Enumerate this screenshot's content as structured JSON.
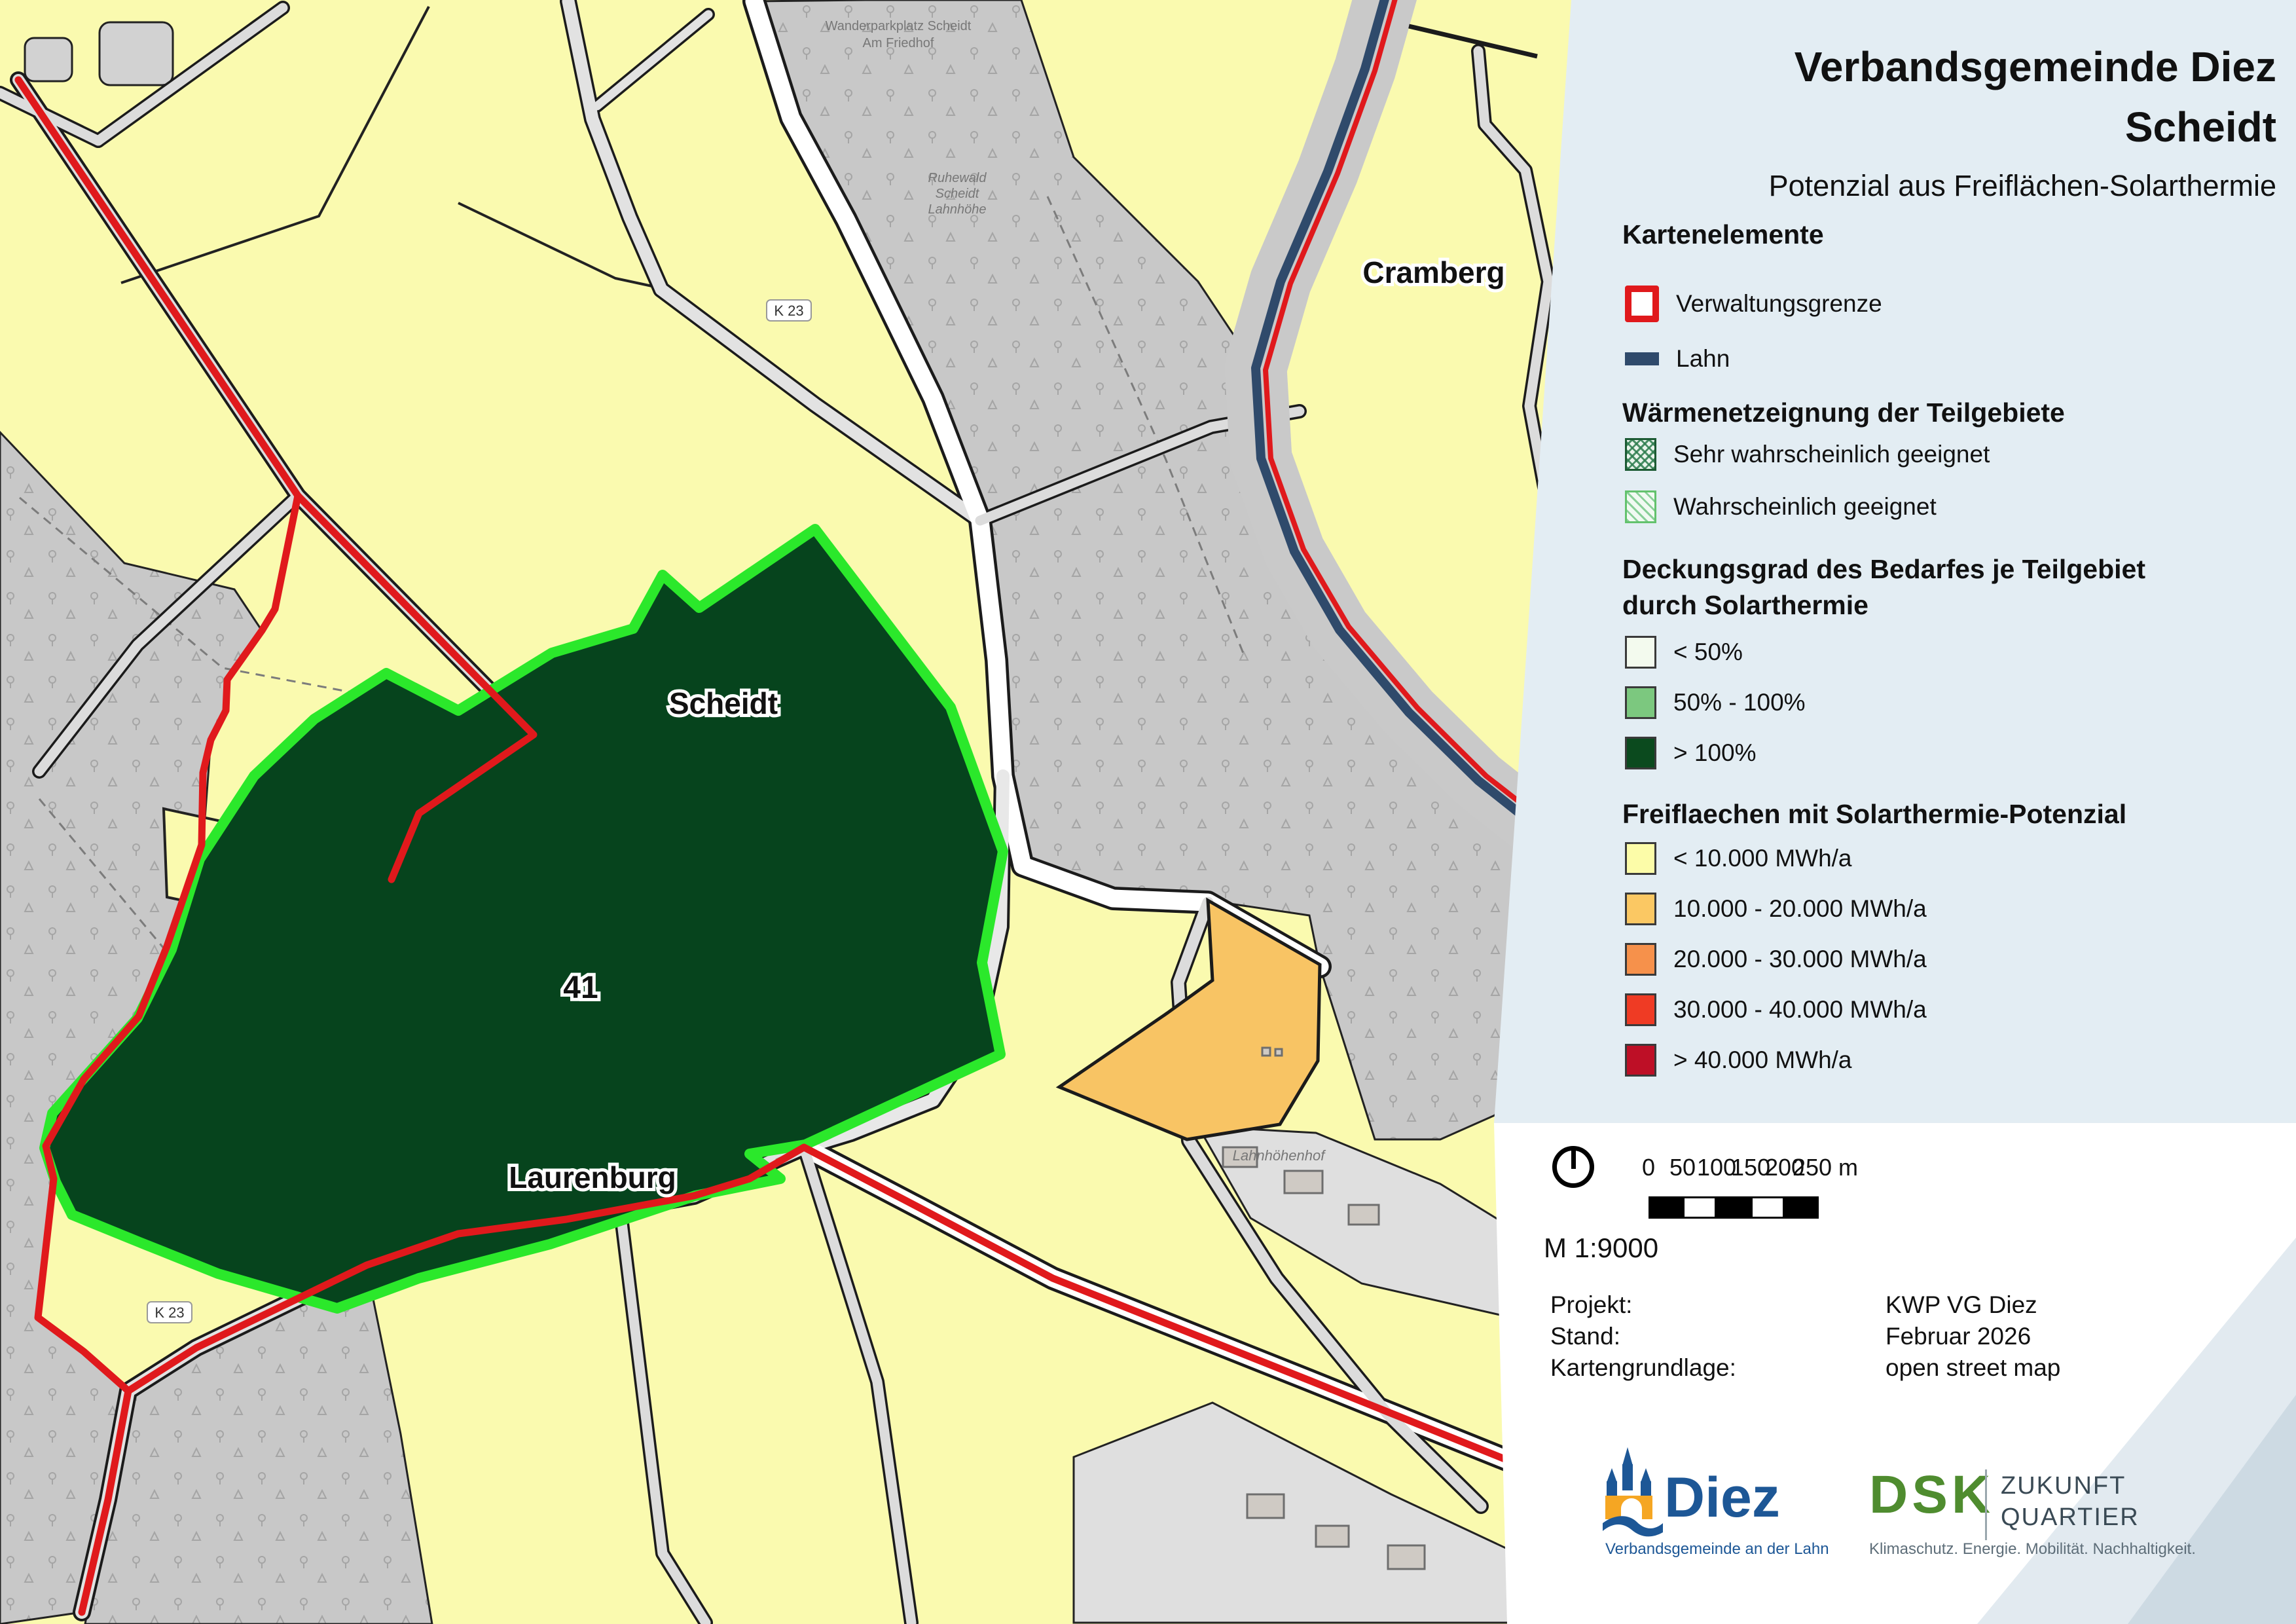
{
  "title": {
    "line1": "Verbandsgemeinde Diez",
    "line2": "Scheidt",
    "subtitle": "Potenzial aus Freiflächen-Solarthermie"
  },
  "legend": {
    "kartenelemente": {
      "heading": "Kartenelemente",
      "items": [
        {
          "label": "Verwaltungsgrenze",
          "color": "#E0191C"
        },
        {
          "label": "Lahn",
          "color": "#2F4A6B"
        }
      ]
    },
    "waermenetz": {
      "heading": "Wärmenetzeignung der Teilgebiete",
      "items": [
        {
          "label": "Sehr wahrscheinlich geeignet",
          "border_color": "#1C5A33"
        },
        {
          "label": "Wahrscheinlich geeignet",
          "border_color": "#63C26D"
        }
      ]
    },
    "deckungsgrad": {
      "heading_line1": "Deckungsgrad des Bedarfes je Teilgebiet",
      "heading_line2": "durch Solarthermie",
      "items": [
        {
          "label": "< 50%",
          "color": "#F3FAEE"
        },
        {
          "label": "50% - 100%",
          "color": "#7CC87F"
        },
        {
          "label": "> 100%",
          "color": "#0B4A1E"
        }
      ]
    },
    "freiflaechen": {
      "heading": "Freiflaechen mit Solarthermie-Potenzial",
      "items": [
        {
          "label": "< 10.000 MWh/a",
          "color": "#FCFCA8"
        },
        {
          "label": "10.000 - 20.000 MWh/a",
          "color": "#FBC863"
        },
        {
          "label": "20.000 - 30.000 MWh/a",
          "color": "#F6914B"
        },
        {
          "label": "30.000 - 40.000 MWh/a",
          "color": "#EF3B24"
        },
        {
          "label": "> 40.000 MWh/a",
          "color": "#BE0F26"
        }
      ]
    }
  },
  "map": {
    "labels": {
      "scheidt": "Scheidt",
      "laurenburg": "Laurenburg",
      "cramberg": "Cramberg",
      "area_number": "41",
      "road_badge": "K 23",
      "wanderparkplatz_1": "Wanderparkplatz Scheidt",
      "wanderparkplatz_2": "Am Friedhof",
      "ruhewald_1": "Ruhewald",
      "ruhewald_2": "Scheidt",
      "ruhewald_3": "Lahnhöhe",
      "lahnhoehenhof": "Lahnhöhenhof"
    },
    "colors": {
      "parcel_yellow": "#FAFAAF",
      "forest_gray": "#C8C8C8",
      "boundary_red": "#E0191C",
      "river_navy": "#2F4A6B",
      "teilgebiet_green_fill": "#06441D",
      "teilgebiet_green_border": "#2BE82B",
      "orange_parcel": "#F8C464",
      "panel_blue": "#E3EDF3"
    }
  },
  "scalebar": {
    "ticks": [
      "0",
      "50",
      "100",
      "150",
      "200"
    ],
    "last_tick": "250 m",
    "scale_text": "M 1:9000"
  },
  "project": {
    "rows": [
      {
        "label": "Projekt:",
        "value": "KWP VG Diez"
      },
      {
        "label": "Stand:",
        "value": "Februar 2026"
      },
      {
        "label": "Kartengrundlage:",
        "value": "open street map"
      }
    ]
  },
  "logos": {
    "diez": {
      "name": "Diez",
      "subtitle": "Verbandsgemeinde an der Lahn"
    },
    "dsk": {
      "name": "DSK",
      "line1": "ZUKUNFT",
      "line2": "QUARTIER",
      "tagline": "Klimaschutz. Energie. Mobilität. Nachhaltigkeit."
    }
  }
}
